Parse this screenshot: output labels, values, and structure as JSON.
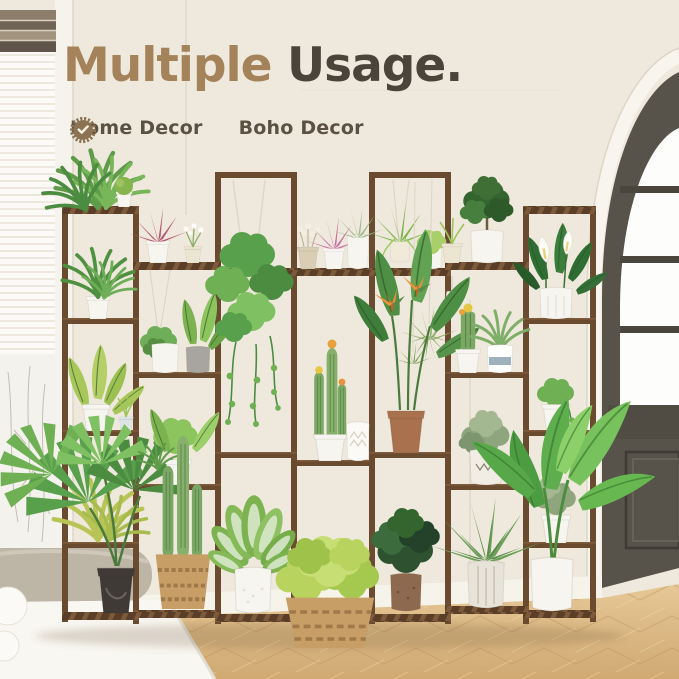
{
  "headline": {
    "word1": "Multiple",
    "word2": "Usage."
  },
  "features": [
    {
      "label": "Home Decor",
      "icon": "seal-check-icon"
    },
    {
      "label": "Boho Decor",
      "icon": "seal-check-icon"
    }
  ],
  "colors": {
    "headline_highlight": "#a5835a",
    "headline_dark": "#4a443a",
    "badge": "#8b7354",
    "badge_check": "#f6f2e8",
    "badge_text": "#5b5142",
    "wall": "#efe9dd",
    "wood": "#6b4b30",
    "wood_dark": "#5a3e27",
    "wood_light": "#7d5a3a",
    "floor_light": "#e6c897",
    "floor_dark": "#d0a972",
    "door": "#57534a",
    "white_pot": "#f7f5ef",
    "terracotta": "#a9714d",
    "basket": "#c79e66",
    "leaf_bright": "#6fb054",
    "leaf_deep": "#2f6e33"
  },
  "scene": {
    "left": "window-with-white-blinds",
    "right": "arched-dark-framed-door",
    "floor": "light-oak-herringbone-floor",
    "furniture": "white-side-table-with-vase",
    "stand": "multi-tier-wooden-plant-stand",
    "plants": [
      "hanging pothos",
      "spider plant",
      "air plants",
      "bird of paradise",
      "succulents",
      "columnar cacti",
      "barrel cactus",
      "fan palm",
      "areca palm",
      "banana plant",
      "peace lily",
      "dieffenbachia",
      "fittonia",
      "rosemary",
      "olive bush",
      "agave",
      "sedum mound",
      "dried flowers",
      "ivy",
      "myrtle topiary"
    ]
  }
}
